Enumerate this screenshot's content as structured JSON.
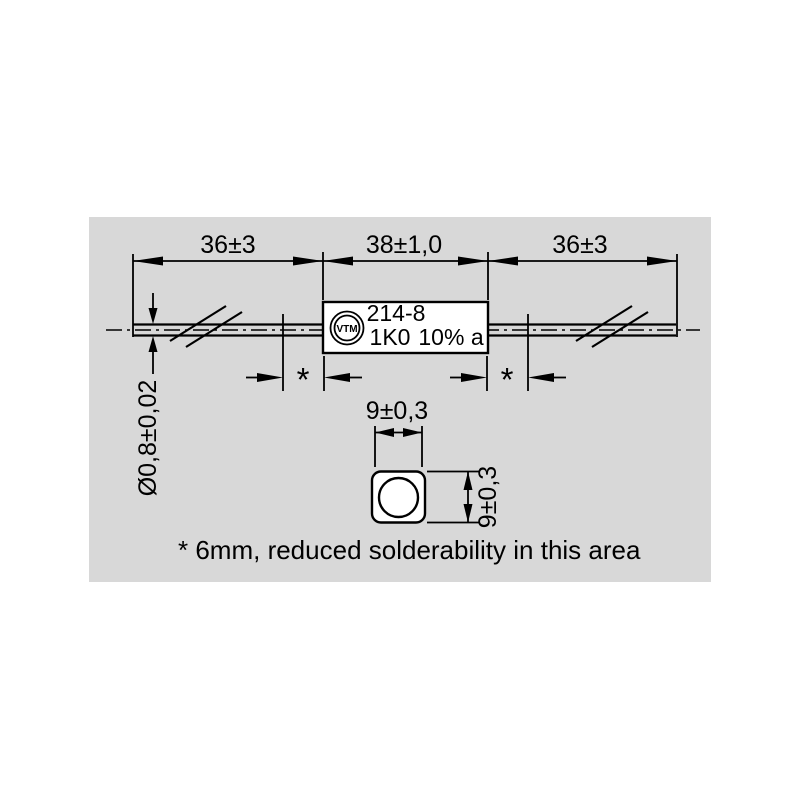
{
  "colors": {
    "panel": "#d8d8d8",
    "line": "#000000",
    "background": "#ffffff"
  },
  "dimensions": {
    "lead_left": "36±3",
    "body_length": "38±1,0",
    "lead_right": "36±3",
    "wire_diameter": "Ø0,8±0,02",
    "section_width": "9±0,3",
    "section_height": "9±0,3"
  },
  "solder_zone": {
    "marker_left": "*",
    "marker_right": "*"
  },
  "resistor": {
    "logo": "VTM",
    "type_code": "214-8",
    "value": "1K0",
    "tolerance": "10% a"
  },
  "footnote": "* 6mm, reduced solderability in this area"
}
